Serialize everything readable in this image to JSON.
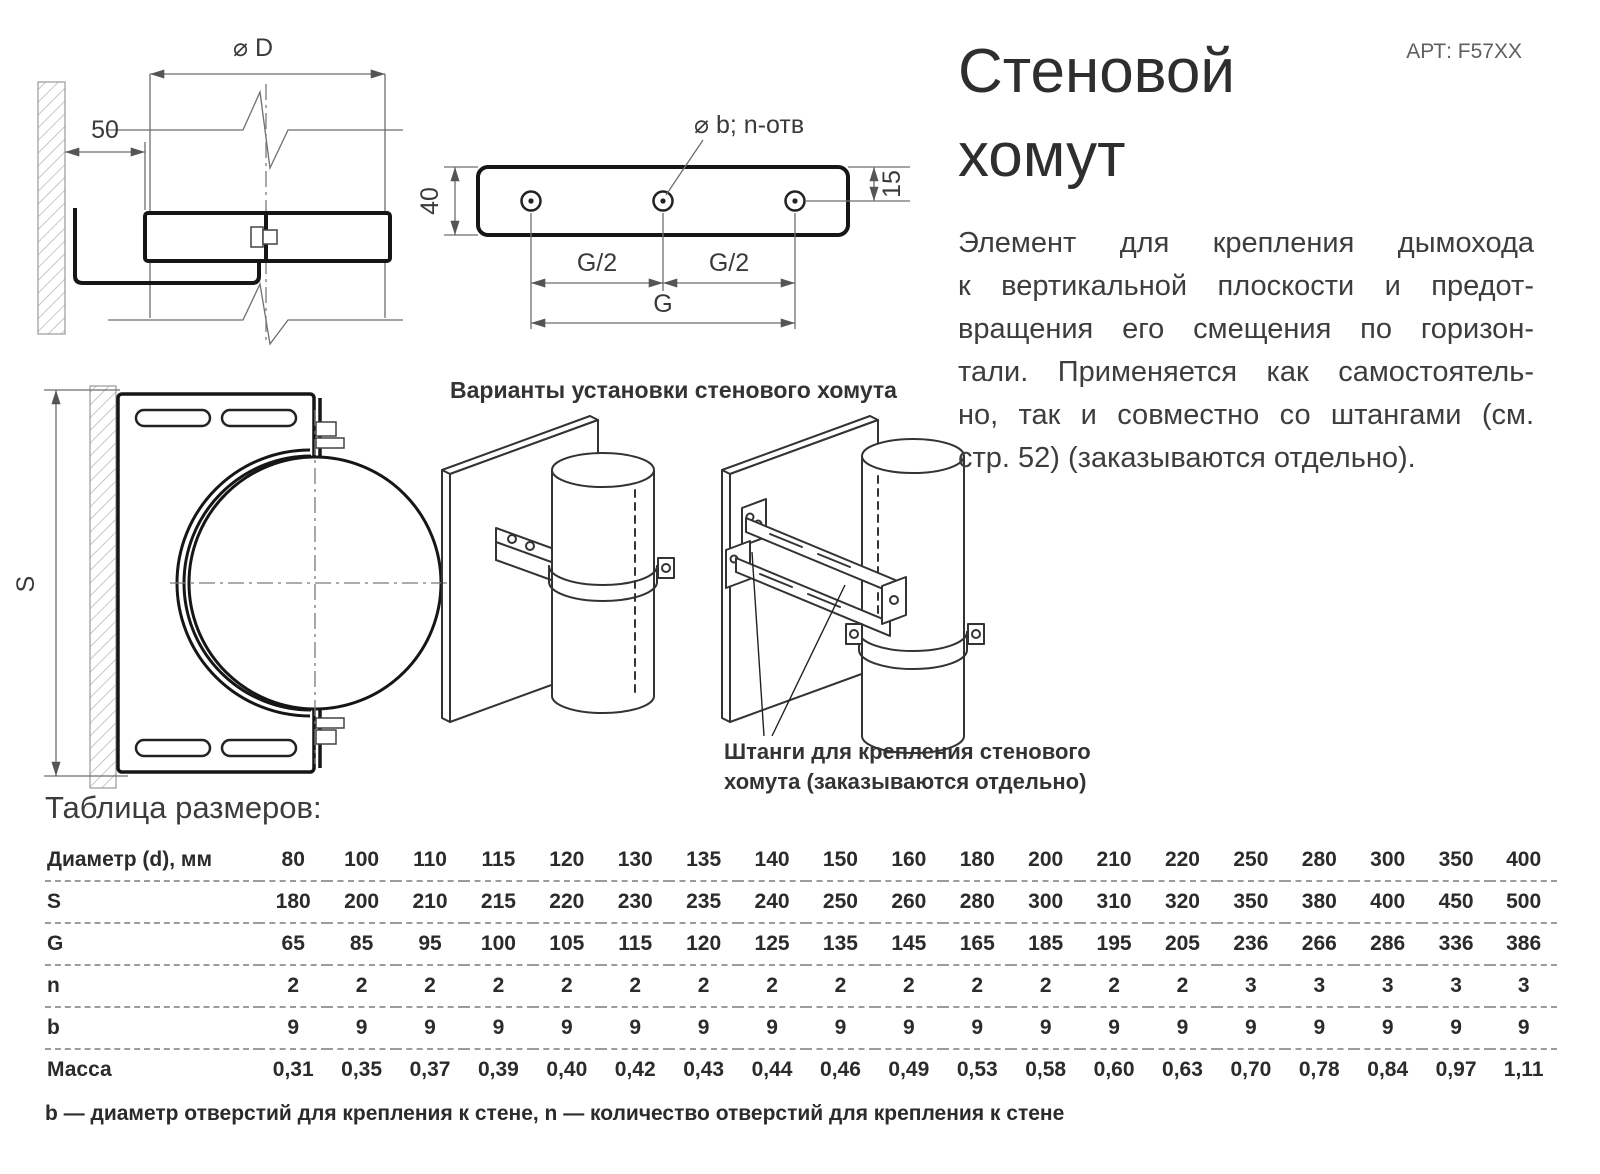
{
  "page": {
    "article": "АРТ: F57XX",
    "title_lines": [
      "Стеновой",
      "хомут"
    ],
    "description_lines": [
      "Элемент для крепления дымохода",
      "к вертикальной плоскости и предот-",
      "вращения его смещения по горизон-",
      "тали. Применяется как самостоятель-",
      "но, так и совместно со штангами (см.",
      "стр. 52) (заказываются отдельно)."
    ]
  },
  "drawings": {
    "side_view": {
      "dim_diameter": "⌀ D",
      "dim_wall_offset": "50"
    },
    "strip_view": {
      "holes_label": "⌀ b; n-отв",
      "dim_height": "40",
      "dim_hole_edge": "15",
      "dim_half_span_left": "G/2",
      "dim_half_span_right": "G/2",
      "dim_full_span": "G"
    },
    "front_view": {
      "dim_height": "S"
    },
    "variants_caption": "Варианты установки стенового хомута",
    "rods_caption_lines": [
      "Штанги для крепления стенового",
      "хомута (заказываются отдельно)"
    ]
  },
  "size_table": {
    "heading": "Таблица размеров:",
    "rows": [
      {
        "label": "Диаметр (d), мм",
        "values": [
          "80",
          "100",
          "110",
          "115",
          "120",
          "130",
          "135",
          "140",
          "150",
          "160",
          "180",
          "200",
          "210",
          "220",
          "250",
          "280",
          "300",
          "350",
          "400"
        ]
      },
      {
        "label": "S",
        "values": [
          "180",
          "200",
          "210",
          "215",
          "220",
          "230",
          "235",
          "240",
          "250",
          "260",
          "280",
          "300",
          "310",
          "320",
          "350",
          "380",
          "400",
          "450",
          "500"
        ]
      },
      {
        "label": "G",
        "values": [
          "65",
          "85",
          "95",
          "100",
          "105",
          "115",
          "120",
          "125",
          "135",
          "145",
          "165",
          "185",
          "195",
          "205",
          "236",
          "266",
          "286",
          "336",
          "386"
        ]
      },
      {
        "label": "n",
        "values": [
          "2",
          "2",
          "2",
          "2",
          "2",
          "2",
          "2",
          "2",
          "2",
          "2",
          "2",
          "2",
          "2",
          "2",
          "3",
          "3",
          "3",
          "3",
          "3"
        ]
      },
      {
        "label": "b",
        "values": [
          "9",
          "9",
          "9",
          "9",
          "9",
          "9",
          "9",
          "9",
          "9",
          "9",
          "9",
          "9",
          "9",
          "9",
          "9",
          "9",
          "9",
          "9",
          "9"
        ]
      },
      {
        "label": "Масса",
        "values": [
          "0,31",
          "0,35",
          "0,37",
          "0,39",
          "0,40",
          "0,42",
          "0,43",
          "0,44",
          "0,46",
          "0,49",
          "0,53",
          "0,58",
          "0,60",
          "0,63",
          "0,70",
          "0,78",
          "0,84",
          "0,97",
          "1,11"
        ]
      }
    ],
    "footnote": "b — диаметр отверстий для крепления к стене, n — количество отверстий для крепления к стене"
  },
  "colors": {
    "accent_line": "#161616",
    "dim_line": "#6e6e6e",
    "dash_separator": "#9c9c9c",
    "muted_text": "#5f5f5f"
  }
}
